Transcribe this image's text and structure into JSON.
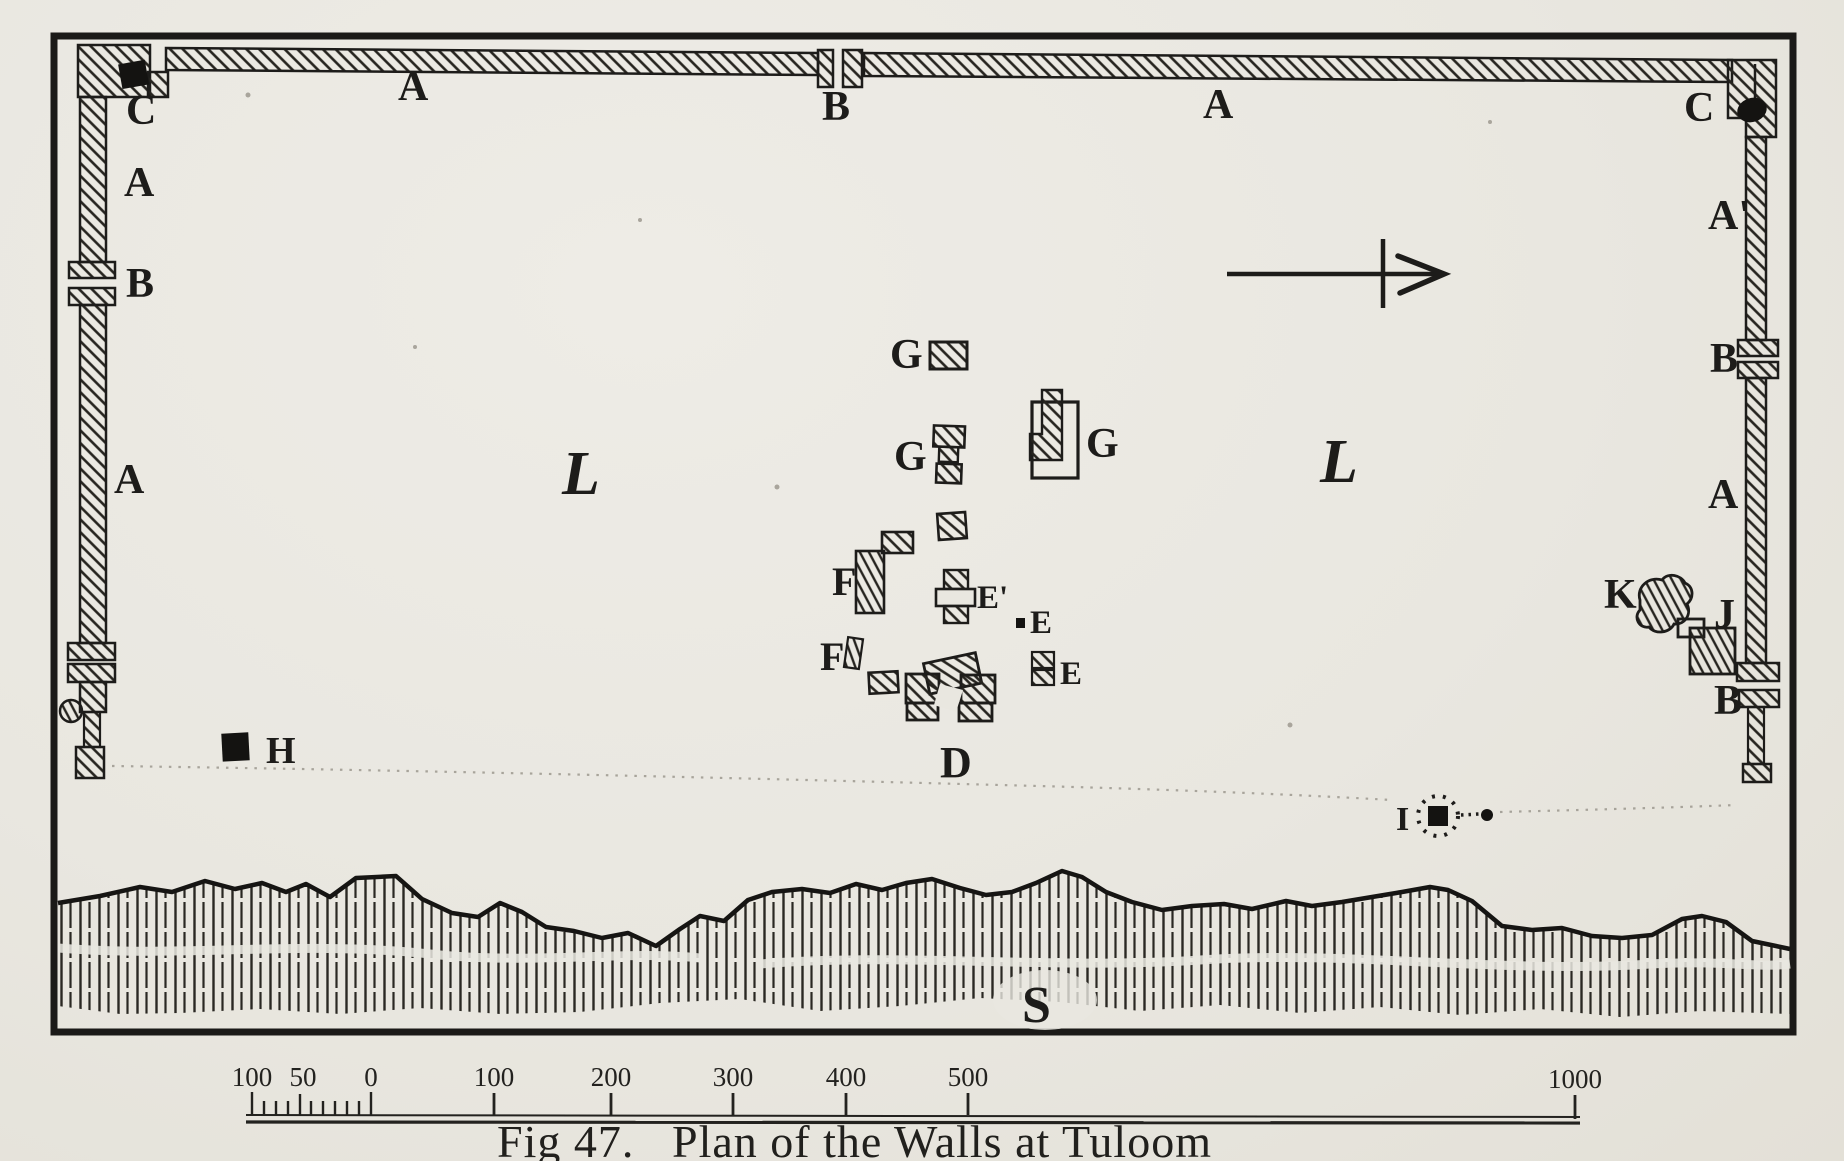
{
  "figure": {
    "caption_fig": "Fig 47.",
    "caption_title": "Plan of the Walls at Tuloom"
  },
  "map": {
    "labels": {
      "c_nw": "C",
      "a_west_top": "A",
      "b_west": "B",
      "a_west_mid": "A",
      "a_north_west": "A",
      "b_north": "B",
      "a_north_east": "A",
      "c_ne": "C",
      "a_prime_east": "A'",
      "b_east_top": "B",
      "a_east_mid": "A",
      "k": "K",
      "j": "J",
      "b_east_bottom": "B",
      "g_north": "G",
      "g_mid": "G",
      "g_east": "G",
      "f_large": "F",
      "f_small": "F",
      "e_prime": "E'",
      "e_mid": "E",
      "e_south": "E",
      "d": "D",
      "h": "H",
      "i": "I",
      "l_plain_west": "L",
      "l_plain_east": "L",
      "s_sea": "S"
    },
    "scale": {
      "labels": [
        "100",
        "50",
        "0",
        "100",
        "200",
        "300",
        "400",
        "500",
        "1000"
      ]
    }
  },
  "colors": {
    "paper": "#e9e7e0",
    "ink": "#1d1c1a"
  }
}
